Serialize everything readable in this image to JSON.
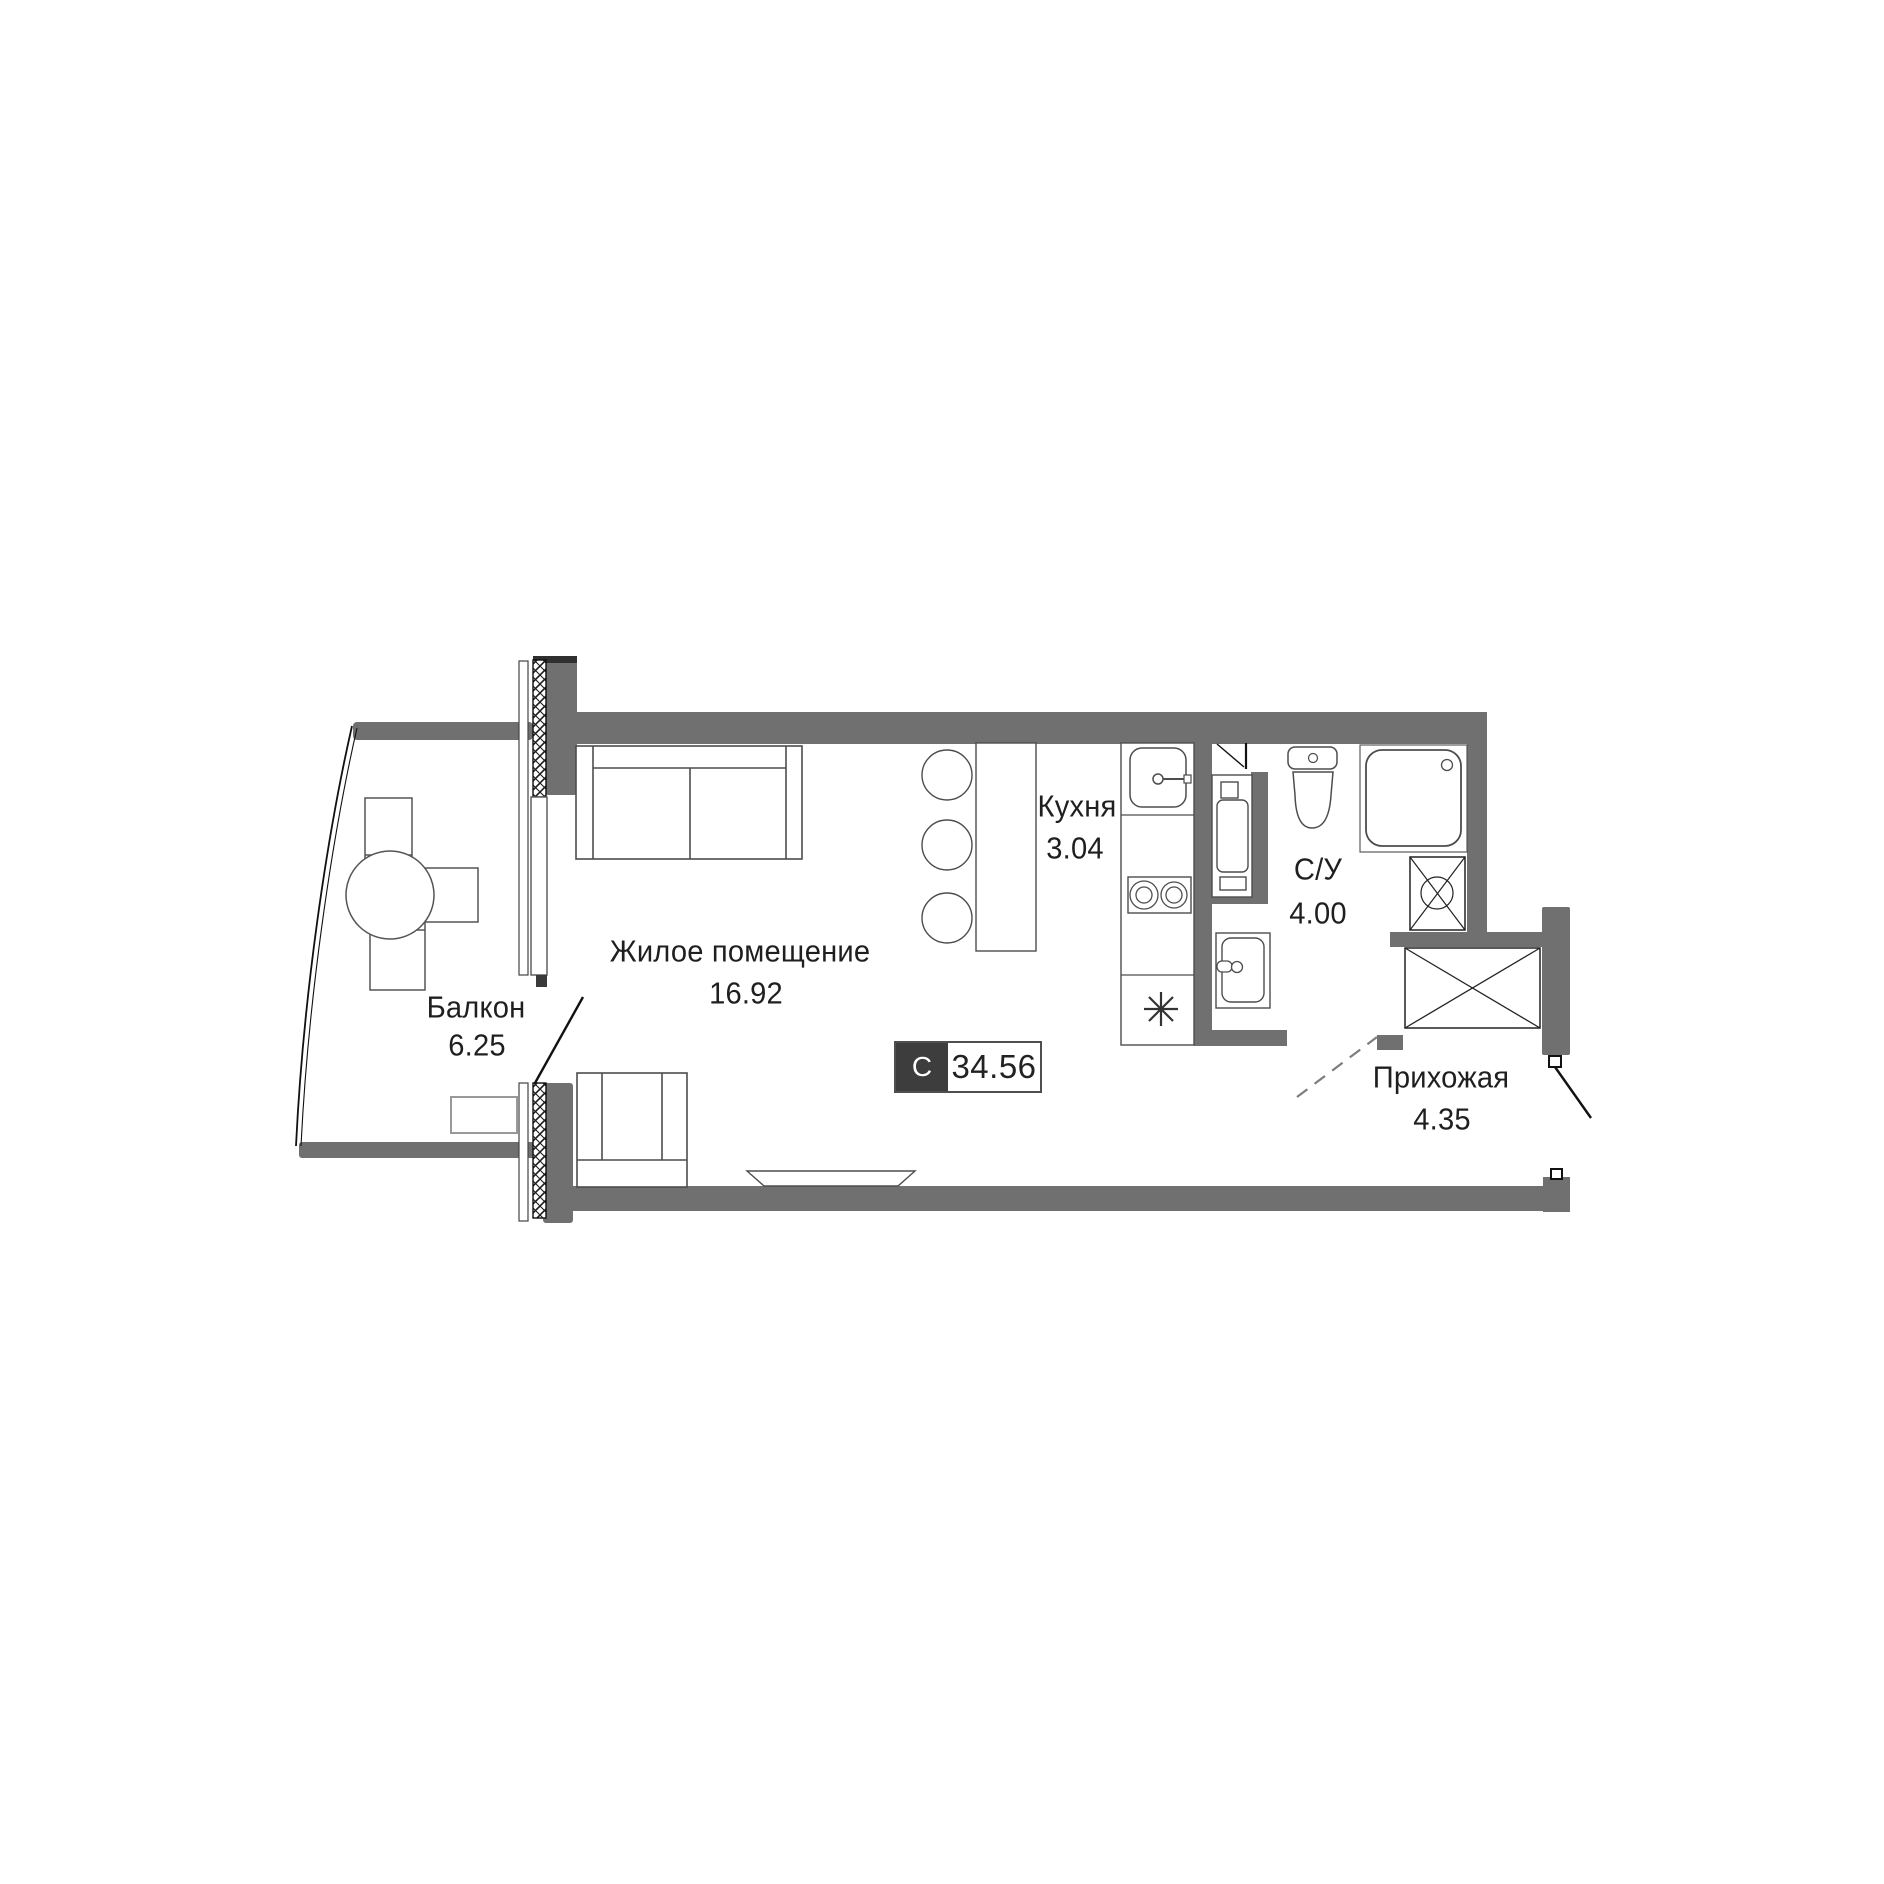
{
  "badge": {
    "letter": "С",
    "value": "34.56"
  },
  "rooms": {
    "living": {
      "name": "Жилое помещение",
      "area": "16.92"
    },
    "balcony": {
      "name": "Балкон",
      "area": "6.25"
    },
    "kitchen": {
      "name": "Кухня",
      "area": "3.04"
    },
    "bathroom": {
      "name": "С/У",
      "area": "4.00"
    },
    "hallway": {
      "name": "Прихожая",
      "area": "4.35"
    }
  },
  "colors": {
    "wall": "#707070",
    "badge_dark": "#3d3d3d",
    "furniture_line": "#4d4d4d",
    "text": "#1f1f1f",
    "background": "#ffffff"
  }
}
